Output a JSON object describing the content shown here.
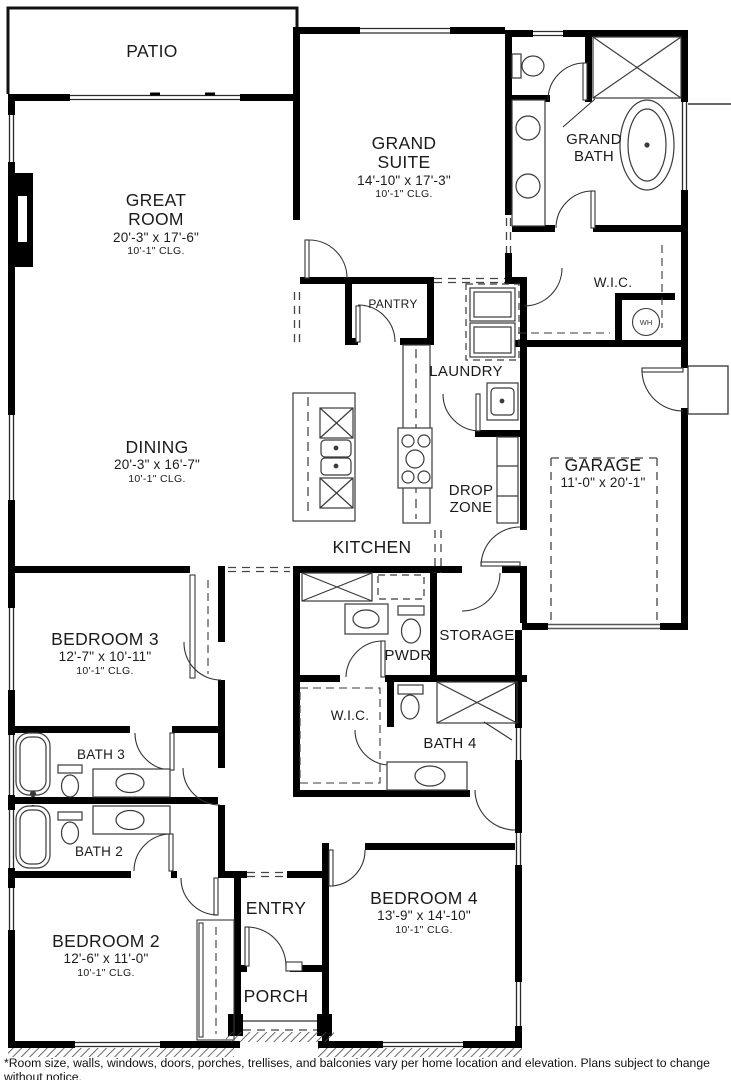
{
  "rooms": [
    {
      "name": "PATIO"
    },
    {
      "name": "GREAT ROOM",
      "dims": "20'-3\" x 17'-6\"",
      "clg": "10'-1\" CLG."
    },
    {
      "name": "GRAND SUITE",
      "dims": "14'-10\" x 17'-3\"",
      "clg": "10'-1\" CLG."
    },
    {
      "name": "GRAND BATH"
    },
    {
      "name": "W.I.C."
    },
    {
      "name": "PANTRY"
    },
    {
      "name": "LAUNDRY"
    },
    {
      "name": "DINING",
      "dims": "20'-3\" x 16'-7\"",
      "clg": "10'-1\" CLG."
    },
    {
      "name": "KITCHEN"
    },
    {
      "name": "DROP ZONE"
    },
    {
      "name": "GARAGE",
      "dims": "11'-0\" x 20'-1\""
    },
    {
      "name": "BEDROOM 3",
      "dims": "12'-7\" x 10'-11\"",
      "clg": "10'-1\" CLG."
    },
    {
      "name": "STORAGE"
    },
    {
      "name": "PWDR"
    },
    {
      "name": "W.I.C."
    },
    {
      "name": "BATH 4"
    },
    {
      "name": "BATH 3"
    },
    {
      "name": "BATH 2"
    },
    {
      "name": "BEDROOM 2",
      "dims": "12'-6\" x 11'-0\"",
      "clg": "10'-1\" CLG."
    },
    {
      "name": "ENTRY"
    },
    {
      "name": "BEDROOM 4",
      "dims": "13'-9\" x 14'-10\"",
      "clg": "10'-1\" CLG."
    },
    {
      "name": "PORCH"
    }
  ],
  "fixtures": {
    "wh": "WH"
  },
  "footer": {
    "disclaimer": "*Room size, walls, windows, doors, porches, trellises, and balconies vary per home location and elevation. Plans subject to change without notice."
  }
}
